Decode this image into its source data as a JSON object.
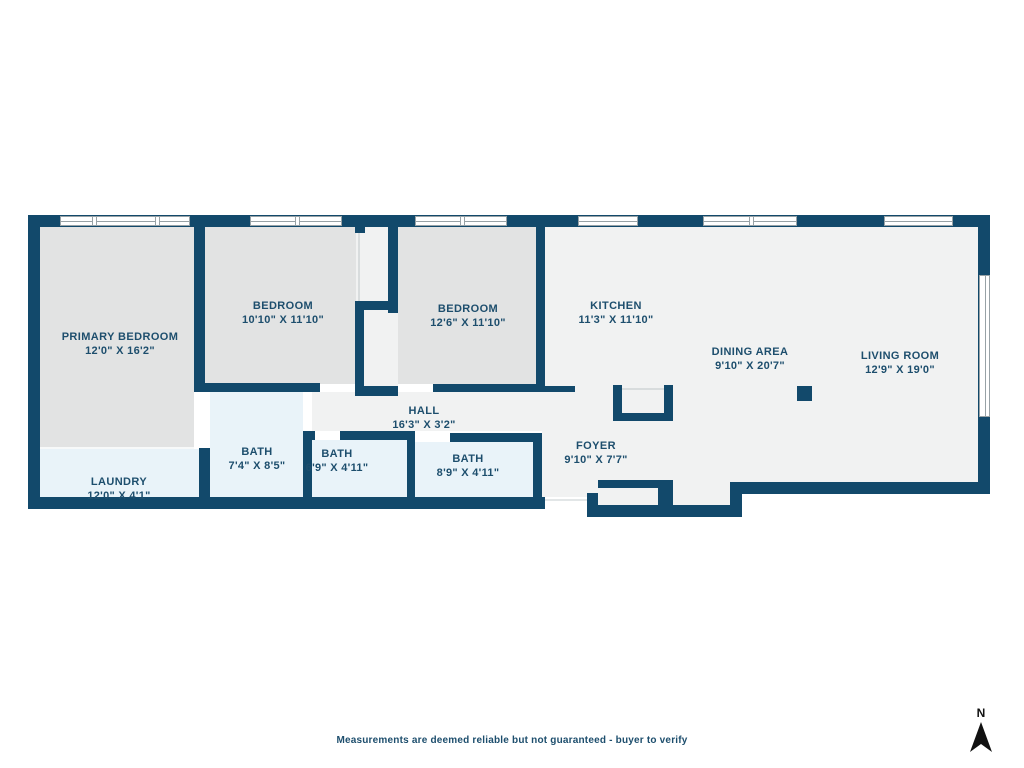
{
  "rooms": {
    "primary_bedroom": {
      "name": "PRIMARY BEDROOM",
      "dims": "12'0\" X 16'2\""
    },
    "bedroom_a": {
      "name": "BEDROOM",
      "dims": "10'10\" X 11'10\""
    },
    "bedroom_b": {
      "name": "BEDROOM",
      "dims": "12'6\" X 11'10\""
    },
    "kitchen": {
      "name": "KITCHEN",
      "dims": "11'3\" X 11'10\""
    },
    "dining_area": {
      "name": "DINING AREA",
      "dims": "9'10\" X 20'7\""
    },
    "living_room": {
      "name": "LIVING ROOM",
      "dims": "12'9\" X 19'0\""
    },
    "hall": {
      "name": "HALL",
      "dims": "16'3\" X 3'2\""
    },
    "bath_primary": {
      "name": "BATH",
      "dims": "7'4\" X 8'5\""
    },
    "bath_small": {
      "name": "BATH",
      "dims": "6'9\" X 4'11\""
    },
    "bath_hall": {
      "name": "BATH",
      "dims": "8'9\" X 4'11\""
    },
    "foyer": {
      "name": "FOYER",
      "dims": "9'10\" X 7'7\""
    },
    "laundry": {
      "name": "LAUNDRY",
      "dims": "12'0\" X 4'1\""
    }
  },
  "footer": {
    "disclaimer": "Measurements are deemed reliable but not guaranteed - buyer to verify"
  },
  "compass": {
    "label": "N"
  },
  "colors": {
    "wall": "#12496b",
    "bedroom_fill": "#e2e3e3",
    "open_fill": "#f1f2f2",
    "wet_fill": "#e9f3f9",
    "text": "#1d4e6d"
  }
}
